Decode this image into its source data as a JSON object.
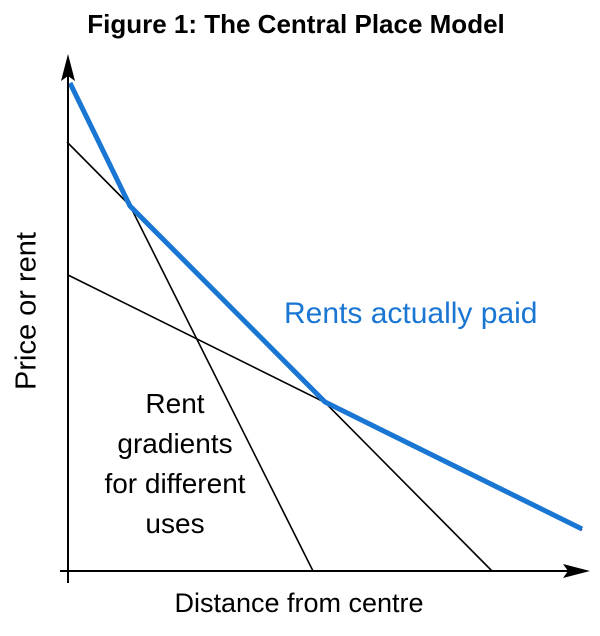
{
  "title": "Figure 1: The Central Place Model",
  "axes": {
    "y_label": "Price or rent",
    "x_label": "Distance from centre"
  },
  "annotations": {
    "envelope_label": "Rents actually paid",
    "gradients_label_lines": [
      "Rent",
      "gradients",
      "for different",
      "uses"
    ]
  },
  "colors": {
    "envelope_blue": "#1976D2",
    "line_black": "#000000",
    "background": "#FFFFFF"
  },
  "chart_data": {
    "type": "line",
    "title": "Figure 1: The Central Place Model",
    "xlabel": "Distance from centre",
    "ylabel": "Price or rent",
    "axes_numeric": false,
    "xlim": [
      0,
      10
    ],
    "ylim": [
      0,
      10
    ],
    "grid": false,
    "legend_position": "none",
    "series": [
      {
        "name": "rent-gradient-steep",
        "group_label": "Rent gradients for different uses",
        "color": "#000000",
        "points": [
          [
            0,
            9.4
          ],
          [
            4.7,
            0
          ]
        ]
      },
      {
        "name": "rent-gradient-middle",
        "group_label": "Rent gradients for different uses",
        "color": "#000000",
        "points": [
          [
            0,
            8.3
          ],
          [
            8.2,
            0
          ]
        ]
      },
      {
        "name": "rent-gradient-shallow",
        "group_label": "Rent gradients for different uses",
        "color": "#000000",
        "points": [
          [
            0,
            5.7
          ],
          [
            9.9,
            0.8
          ]
        ]
      },
      {
        "name": "rents-actually-paid-envelope",
        "group_label": "Rents actually paid",
        "color": "#1976D2",
        "points": [
          [
            0,
            9.4
          ],
          [
            1.2,
            7.1
          ],
          [
            4.9,
            3.3
          ],
          [
            9.9,
            0.8
          ]
        ]
      }
    ],
    "pixel_geometry": {
      "x_axis_shaft": [
        [
          60,
          571
        ],
        [
          580,
          571
        ]
      ],
      "x_axis_arrow": [
        [
          590,
          571
        ],
        [
          563,
          564
        ],
        [
          568,
          571
        ],
        [
          563,
          578
        ]
      ],
      "y_axis_shaft": [
        [
          68,
          583
        ],
        [
          68,
          76
        ]
      ],
      "y_axis_arrow": [
        [
          68,
          54
        ],
        [
          61,
          81
        ],
        [
          68,
          76
        ],
        [
          75,
          81
        ]
      ],
      "black_lines": [
        [
          [
            69,
            84
          ],
          [
            313,
            571
          ]
        ],
        [
          [
            67,
            142
          ],
          [
            492,
            571
          ]
        ],
        [
          [
            68,
            275
          ],
          [
            582,
            530
          ]
        ]
      ],
      "envelope": [
        [
          70,
          83
        ],
        [
          130,
          206
        ],
        [
          325,
          402
        ],
        [
          582,
          529
        ]
      ],
      "black_line_width": 1.6,
      "axis_width": 2,
      "envelope_width": 5
    }
  }
}
